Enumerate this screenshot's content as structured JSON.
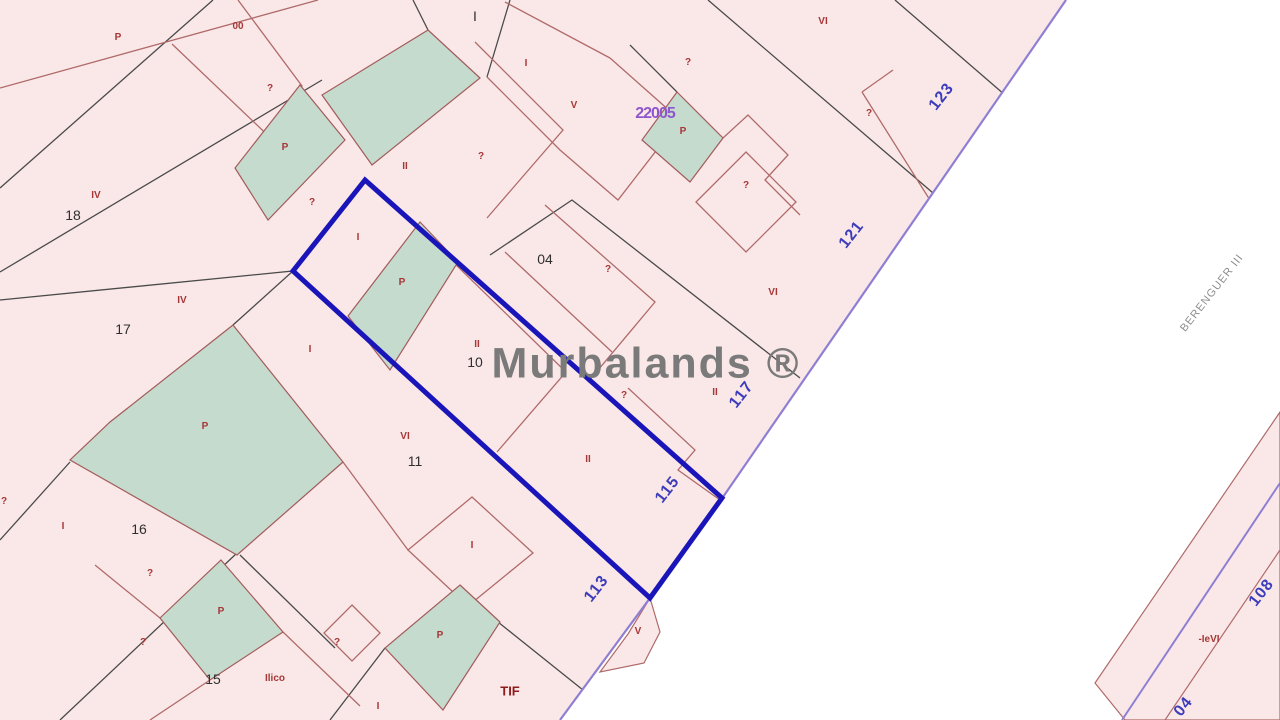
{
  "map": {
    "watermark": "Murbalands ®",
    "street_name": "BERENGUER III",
    "block_ref": "22005",
    "colors": {
      "background_pink": "#fae8e8",
      "parcel_green": "#c4dbce",
      "highlight_blue": "#1a15b8",
      "street_violet": "#8f7fd4",
      "parcel_line_red": "#b06a6a",
      "parcel_line_dark": "#4a4a4a",
      "street_number_blue": "#3d3dbb",
      "label_red": "#a63737",
      "watermark_gray": "#7a7a7a"
    },
    "street_numbers": [
      {
        "text": "123",
        "x": 942,
        "y": 97
      },
      {
        "text": "121",
        "x": 852,
        "y": 235
      },
      {
        "text": "117",
        "x": 742,
        "y": 395
      },
      {
        "text": "115",
        "x": 668,
        "y": 490
      },
      {
        "text": "113",
        "x": 597,
        "y": 589
      },
      {
        "text": "108",
        "x": 1262,
        "y": 593
      },
      {
        "text": "04",
        "x": 1184,
        "y": 707
      }
    ],
    "parcel_numbers": [
      {
        "text": "18",
        "x": 73,
        "y": 215
      },
      {
        "text": "17",
        "x": 123,
        "y": 329
      },
      {
        "text": "16",
        "x": 139,
        "y": 529
      },
      {
        "text": "15",
        "x": 213,
        "y": 679
      },
      {
        "text": "10",
        "x": 475,
        "y": 362
      },
      {
        "text": "11",
        "x": 415,
        "y": 461
      },
      {
        "text": "04",
        "x": 545,
        "y": 259
      },
      {
        "text": "I",
        "x": 475,
        "y": 16
      }
    ],
    "unit_marks": [
      {
        "text": "P",
        "x": 118,
        "y": 38
      },
      {
        "text": "00",
        "x": 238,
        "y": 27
      },
      {
        "text": "?",
        "x": 270,
        "y": 89
      },
      {
        "text": "P",
        "x": 285,
        "y": 148
      },
      {
        "text": "?",
        "x": 312,
        "y": 203
      },
      {
        "text": "I",
        "x": 526,
        "y": 64
      },
      {
        "text": "V",
        "x": 574,
        "y": 106
      },
      {
        "text": "?",
        "x": 481,
        "y": 157
      },
      {
        "text": "II",
        "x": 405,
        "y": 167
      },
      {
        "text": "I",
        "x": 358,
        "y": 238
      },
      {
        "text": "P",
        "x": 402,
        "y": 283
      },
      {
        "text": "I",
        "x": 310,
        "y": 350
      },
      {
        "text": "II",
        "x": 477,
        "y": 345
      },
      {
        "text": "?",
        "x": 608,
        "y": 270
      },
      {
        "text": "VI",
        "x": 773,
        "y": 293
      },
      {
        "text": "VI",
        "x": 823,
        "y": 22
      },
      {
        "text": "?",
        "x": 688,
        "y": 63
      },
      {
        "text": "P",
        "x": 683,
        "y": 132
      },
      {
        "text": "?",
        "x": 869,
        "y": 114
      },
      {
        "text": "?",
        "x": 746,
        "y": 186
      },
      {
        "text": "IV",
        "x": 96,
        "y": 196
      },
      {
        "text": "IV",
        "x": 182,
        "y": 301
      },
      {
        "text": "P",
        "x": 205,
        "y": 427
      },
      {
        "text": "VI",
        "x": 405,
        "y": 437
      },
      {
        "text": "II",
        "x": 588,
        "y": 460
      },
      {
        "text": "?",
        "x": 624,
        "y": 396
      },
      {
        "text": "II",
        "x": 715,
        "y": 393
      },
      {
        "text": "I",
        "x": 63,
        "y": 527
      },
      {
        "text": "?",
        "x": 150,
        "y": 574
      },
      {
        "text": "?",
        "x": 4,
        "y": 502
      },
      {
        "text": "P",
        "x": 221,
        "y": 612
      },
      {
        "text": "?",
        "x": 143,
        "y": 643
      },
      {
        "text": "Ilico",
        "x": 275,
        "y": 679
      },
      {
        "text": "?",
        "x": 337,
        "y": 643
      },
      {
        "text": "I",
        "x": 472,
        "y": 546
      },
      {
        "text": "P",
        "x": 440,
        "y": 636
      },
      {
        "text": "TIF",
        "x": 510,
        "y": 691,
        "strong": true
      },
      {
        "text": "V",
        "x": 638,
        "y": 632
      },
      {
        "text": "I",
        "x": 378,
        "y": 707
      },
      {
        "text": "-IeVI",
        "x": 1209,
        "y": 640
      }
    ]
  }
}
